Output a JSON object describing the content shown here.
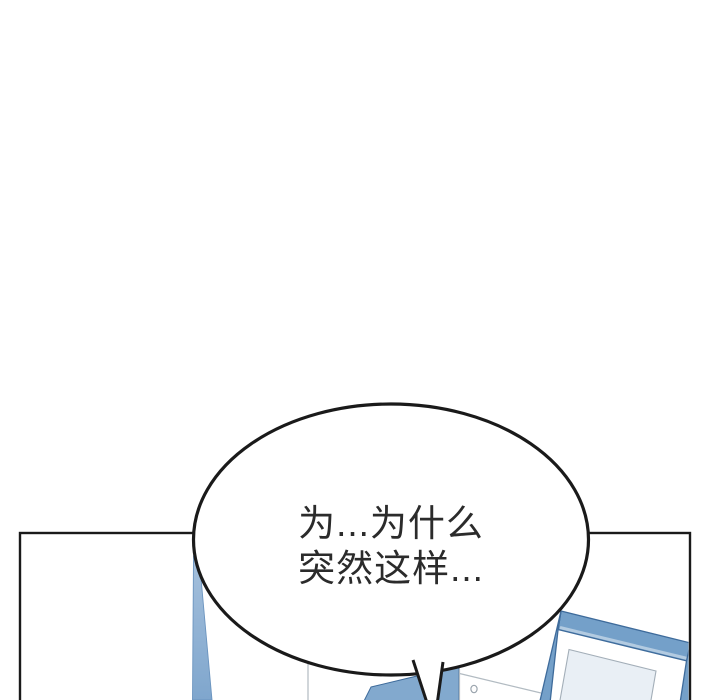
{
  "speech_bubble": {
    "line1": "为...为什么",
    "line2": "突然这样..."
  },
  "colors": {
    "background": "#ffffff",
    "ink": "#1a1a1a",
    "text": "#2b2b2b",
    "blue_fill": "#82a9ce",
    "blue_frame": "#74a0c9",
    "blue_dark": "#3e6b9b",
    "blue_taper_top": "#a5c0dc",
    "blue_taper_bottom": "#7fa6cd",
    "blue_highlight": "#b3cbe1",
    "picture_fill": "#e9eff5",
    "furniture_line": "#b2bbc2"
  }
}
